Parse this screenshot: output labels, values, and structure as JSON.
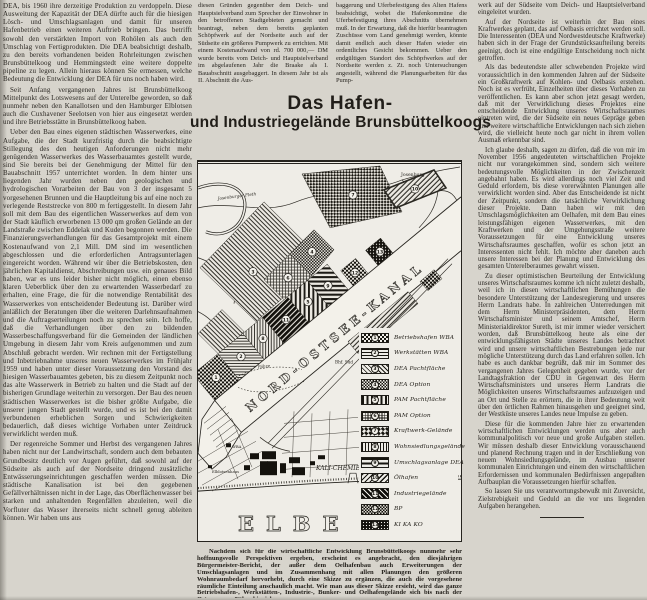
{
  "title": {
    "line1": "Das Hafen-",
    "line2": "und Industriegelände Brunsbüttelkoogs"
  },
  "columns": {
    "left": {
      "paragraphs": [
        "DEA, bis 1960 ihre derzeitige Produktion zu verdoppeln. Diese Ausweitung der Kapazität der DEA dürfte auch für die hiesigen Lösch- und Umschlagsanlagen und damit für unseren Hafenbetrieb einen weiteren Auftrieb bringen. Das betrifft sowohl den verstärkten Import von Rohölen als auch den Umschlag von Fertigprodukten. Die DEA beabsichtigt deshalb, zu den bereits vorhandenen beiden Rohrleitungen zwischen Brunsbüttelkoog und Hemmingstedt eine weitere doppelte pipeline zu legen. Allein hieraus können Sie ermessen, welche Bedeutung die Entwicklung der DEA für uns noch haben wird.",
        "Seit Anfang vergangenen Jahres ist Brunsbüttelkoog Mittelpunkt des Lotswesens auf der Unterelbe geworden, so daß nunmehr neben den Kanallotsen und den Hamburger Elblotsen auch die Cuxhavener Seelotsen von hier aus eingesetzt werden und ihre Betriebsstätte in Brunsbüttelkoog haben.",
        "Ueber den Bau eines eigenen städtischen Wasserwerkes, eine Aufgabe, die der Stadt kurzfristig durch die beabsichtigte Stillegung des den heutigen Anforderungen nicht mehr genügenden Wasserwerkes des Wasserbauamtes gestellt wurde, sind Sie bereits bei der Genehmigung der Mittel für den Bauabschnitt 1957 unterrichtet worden. In dem hinter uns liegenden Jahr wurden neben den geologischen und hydrologischen Vorarbeiten der Bau von 3 der insgesamt 5 vorgesehenen Brunnen und die Hauptleitung bis auf eine noch zu verlegende Reststrecke von 800 m fertiggestellt. In diesem Jahr soll mit dem Bau des eigentlichen Wasserwerkes auf dem von der Stadt käuflich erworbenen 13 000 qm großen Gelände an der Landstraße zwischen Eddelak und Kuden begonnen werden. Die Finanzierungsverhandlungen für das Gesamtprojekt mit einem Kostenaufwand von 2,1 Mill. DM sind im wesentlichen abgeschlossen und die erforderlichen Antragsunterlagen eingereicht worden. Während wir über die Betriebskosten, den jährlichen Kapitaldienst, Abschreibungen usw. ein genaues Bild haben, war es uns leider bisher nicht möglich, einen ebenso klaren Ueberblick über den zu erwartenden Wasserbedarf zu erhalten, eine Frage, die für die notwendige Rentabilität des Wasserwerkes von entscheidender Bedeutung ist. Darüber wird anläßlich der Beratungen über die weiteren Darlehnsaufnahmen und die Auftragserteilungen noch zu sprechen sein. Ich hoffe, daß die Verhandlungen über den zu bildenden Wasserbeschaffungsverband für die Gemeinden der ländlichen Umgebung in diesem Jahr vom Kreis aufgenommen und zum Abschluß gebracht werden. Wir rechnen mit der Fertigstellung und Inbetriebnahme unseres neuen Wasserwerkes im Frühjahr 1959 und haben unter dieser Voraussetzung den Vorstand des hiesigen Wasserbauamtes gebeten, bis zu diesem Zeitpunkt noch das alte Wasserwerk in Betrieb zu halten und die Stadt auf der bisherigen Grundlage weiterhin zu versorgen. Der Bau des neuen städtischen Wasserwerkes ist die bisher größte Aufgabe, die unserer jungen Stadt gestellt wurde, und es ist bei den damit verbundenen erheblichen Sorgen und Schwierigkeiten bedauerlich, daß dieses wichtige Vorhaben unter Zeitdruck verwirklicht werden muß.",
        "Der regenreiche Sommer und Herbst des vergangenen Jahres haben nicht nur der Landwirtschaft, sondern auch dem bebauten Grundbesitz deutlich vor Augen geführt, daß sowohl auf der Südseite als auch auf der Nordseite dringend zusätzliche Entwässerungseinrichtungen geschaffen werden müssen. Die städtische Kanalisation ist bei den gegebenen Gefällverhältnissen nicht in der Lage, das Oberflächenwasser bei starken und anhaltenden Regenfällen abzuleiten, weil die Vorfluter das Wasser ihrerseits nicht schnell genug ableiten können. Wir haben uns aus"
      ]
    },
    "mid_a": {
      "paragraphs": [
        "diesen Gründen gegenüber dem Deich- und Hauptsielverband zum Sprecher der Einwohner in den betroffenen Stadtgebieten gemacht und beantragt, neben dem bereits geplanten Schöpfwerk auf der Nordseite auch auf der Südseite ein größeres Pumpwerk zu errichten. Mit einem Kostenaufwand von rd. 700 000,— DM wurde bereits vom Deich- und Hauptsielverband im abgelaufenen Jahr die Braake als I. Bauabschnitt ausgebaggert. In diesem Jahr ist als II. Abschnitt die Aus-"
      ]
    },
    "mid_b": {
      "paragraphs": [
        "baggerung und Uferbefestigung des Alten Hafens beabsichtigt, wobei die Hafenkommüne die Uferbefestigung ihres Abschnitts übernehmen muß. In der Erwartung, daß die hierfür beantragten Zuschüsse vom Land genehmigt werden, könnte damit endlich auch dieser Hafen wieder ein ordentliches Gesicht bekommen. Ueber den endgültigen Standort des Schöpfwerkes auf der Nordseite werden z. Zt. noch Untersuchungen angestellt, während die Planungsarbeiten für das Pump-"
      ]
    },
    "right": {
      "paragraphs": [
        "werk auf der Südseite vom Deich- und Hauptsielverband eingeleitet wurden.",
        "Auf der Nordseite ist weiterhin der Bau eines Kraftwerkes geplant, das auf Oelbasis errichtet werden soll. Die Interessenten (DEA und Nordwestdeutsche Kraftwerke) haben sich in der Frage der Grundstücksaufteilung bereits geeinigt, doch ist eine endgültige Entscheidung noch nicht getroffen.",
        "Als das bedeutendste aller schwebenden Projekte wird voraussichtlich in den kommenden Jahren auf der Südseite ein Großkraftwerk auf Kohlen- und Oelbasis erstehen. Noch ist es verfrüht, Einzelheiten über dieses Vorhaben zu veröffentlichen. Es kann aber schon jetzt gesagt werden, daß mit der Verwirklichung dieses Projektes eine entscheidende Entwicklung unseres Wirtschaftsraumes eintreten wird, die der Südseite ein neues Gepräge geben und weitere wirtschaftliche Entwicklungen nach sich ziehen wird, die vielleicht heute noch gar nicht in ihrem vollen Ausmaß erkennbar sind.",
        "Ich glaube deshalb, sagen zu dürfen, daß die von mir im November 1956 angedeuteten wirtschaftlichen Projekte nicht nur vorangekommen sind, sondern sich weitere bedeutungsvolle Möglichkeiten in der Zwischenzeit angebahnt haben. Es wird allerdings noch viel Zeit und Geduld erfordern, bis diese vorerwähnten Planungen alle verwirklicht worden sind. Aber das Entscheidende ist nicht der Zeitpunkt, sondern die tatsächliche Verwirklichung dieser Projekte. Dann haben wir mit den Umschlagsmöglichkeiten am Oelhafen, mit dem Bau eines leistungsfähigen eigenen Wasserwerkes, mit den Kraftwerken und der Umgehungsstraße weitere Voraussetzungen für eine Entwicklung unseres Wirtschaftsraumes geschaffen, wofür es schon jetzt an Interessenten nicht fehlt. Ich möchte aber daneben auch unsere Interessen bei der Planung und Entwicklung des gesamten Unterelberaumes gewahrt wissen.",
        "Zu dieser optimistischen Beurteilung der Entwicklung unseres Wirtschaftsraumes komme ich nicht zuletzt deshalb, weil ich in diesen wirtschaftlichen Bemühungen die besondere Unterstützung der Landesregierung und unseres Herrn Landrats habe. In zahlreichen Unterredungen mit dem Herrn Ministerpräsidenten, dem Herrn Wirtschaftsminister und seinem Amtschef, Herrn Ministerialdirektor Sureth, ist mir immer wieder versichert worden, daß Brunsbüttelkoog heute als eine der entwicklungsfähigsten Städte unseres Landes betrachtet wird und unsere wirtschaftlichen Bestrebungen jede nur mögliche Unterstützung durch das Land erfahren sollen. Ich habe es auch dankbar begrüßt, daß mir im Sommer des vergangenen Jahres Gelegenheit gegeben wurde, vor der Landtagsfraktion der CDU in Gegenwart des Herrn Wirtschaftsministers und unseres Herrn Landrats die Möglichkeiten unseres Wirtschaftsraumes aufzuzeigen und an Ort und Stelle zu erörtern, die in ihrer Bedeutung weit über den örtlichen Rahmen hinausgehen und geeignet sind, der Westküste unseres Landes neue Impulse zu geben.",
        "Diese für die kommenden Jahre hier zu erwartenden wirtschaftlichen Entwicklungen werden uns aber auch kommunalpolitisch vor neue und große Aufgaben stellen. Wir müssen deshalb dieser Entwicklung vorausschauend und planend Rechnung tragen und in der Erschließung von neuem Wohnsiedlungsgelände, im Ausbau unserer kommunalen Einrichtungen und einem den wirtschaftlichen Erfordernissen und kommunalen Bedürfnissen angepaßten Aufbauplan die Voraussetzungen hierfür schaffen.",
        "So lassen Sie uns verantwortungsbewußt mit Zuversicht, Zielstrebigkeit und Geduld an die vor uns liegenden Aufgaben herangehen."
      ]
    }
  },
  "figure": {
    "legend": [
      {
        "number": "1",
        "label": "Betriebshafen WBA",
        "pattern": "checkerdark"
      },
      {
        "number": "2",
        "label": "Werkstätten WBA",
        "pattern": "hlines"
      },
      {
        "number": "3",
        "label": "DEA Pachtfläche",
        "pattern": "diag"
      },
      {
        "number": "4",
        "label": "DEA Option",
        "pattern": "checker"
      },
      {
        "number": "5",
        "label": "PAM Pachtfläche",
        "pattern": "vbars"
      },
      {
        "number": "6",
        "label": "PAM Option",
        "pattern": "grid"
      },
      {
        "number": "7",
        "label": "Kraftwerk-Gelände",
        "pattern": "diamond"
      },
      {
        "number": "8",
        "label": "Wohnsiedlungsgelände",
        "pattern": "vlines"
      },
      {
        "number": "9",
        "label": "Umschlagsanlage DEA",
        "pattern": "hstripes"
      },
      {
        "number": "10",
        "label": "Ölhafen",
        "pattern": "diag2"
      },
      {
        "number": "11",
        "label": "Industriegelände",
        "pattern": "darkdiag"
      },
      {
        "number": "12",
        "label": "BP",
        "pattern": "bp"
      },
      {
        "number": "13",
        "label": "KI KA KO",
        "pattern": "dotsdark"
      }
    ],
    "map": {
      "badges": [
        {
          "n": "1",
          "x": 18,
          "y": 216
        },
        {
          "n": "2",
          "x": 43,
          "y": 195
        },
        {
          "n": "8",
          "x": 65,
          "y": 177
        },
        {
          "n": "11",
          "x": 88,
          "y": 158
        },
        {
          "n": "5",
          "x": 110,
          "y": 140
        },
        {
          "n": "9",
          "x": 130,
          "y": 124
        },
        {
          "n": "12",
          "x": 157,
          "y": 111
        },
        {
          "n": "13",
          "x": 182,
          "y": 90
        },
        {
          "n": "3",
          "x": 55,
          "y": 110
        },
        {
          "n": "6",
          "x": 90,
          "y": 116
        },
        {
          "n": "4",
          "x": 114,
          "y": 90
        },
        {
          "n": "7",
          "x": 155,
          "y": 33
        },
        {
          "n": "10",
          "x": 217,
          "y": 27
        }
      ],
      "labels": [
        {
          "text": "Josenburg",
          "x": 203,
          "y": 14,
          "size": 4.6,
          "cls": ""
        },
        {
          "text": "Josenburger Fleth",
          "x": 20,
          "y": 38,
          "size": 4.2,
          "rot": -7,
          "cls": "ml-italic"
        },
        {
          "text": "NORD-OSTSEE-KANAL",
          "x": 52,
          "y": 251,
          "size": 12,
          "rot": -39.5,
          "spacing": 4.2,
          "cls": "ml-canal"
        },
        {
          "text": "Bhf. Süd",
          "x": 137,
          "y": 202,
          "size": 4.2,
          "cls": ""
        },
        {
          "text": "Fähre",
          "x": 60,
          "y": 207,
          "size": 4.2,
          "rot": -6,
          "cls": "ml-italic"
        },
        {
          "text": "WBA",
          "x": 34,
          "y": 287,
          "size": 3.8,
          "cls": ""
        },
        {
          "text": "Elblotsenhaus",
          "x": 14,
          "y": 312,
          "size": 3.8,
          "cls": ""
        },
        {
          "text": "KALI-CHEMIE",
          "x": 118,
          "y": 309,
          "size": 6,
          "cls": "ml-italic"
        },
        {
          "text": "ELBE",
          "x": 40,
          "y": 370,
          "size": 21,
          "spacing": 12,
          "cls": "ml-elbe"
        }
      ]
    }
  },
  "caption": "Nachdem sich für die wirtschaftliche Entwicklung Brunsbüttelkoogs nunmehr sehr hoffnungsvolle Perspektiven ergeben, erscheint es angebracht, den diesjährigen Bürgermeister-Bericht, der außer dem Oelhafenbau auch Erweiterungen der Umschlagsanlagen und im Zusammenhang mit allen Planungen den größeren Wohnraumbedarf hervorhebt, durch eine Skizze zu ergänzen, die auch die vorgesehene räumliche Einteilung anschaulich macht. Wie man aus dieser Skizze ersieht, wird das ganze Betriebshafen-, Werkstätten-, Industrie-, Bunker- und Oelhafengelände sich bis nach der Ostermoorer Fähre hinziehen."
}
